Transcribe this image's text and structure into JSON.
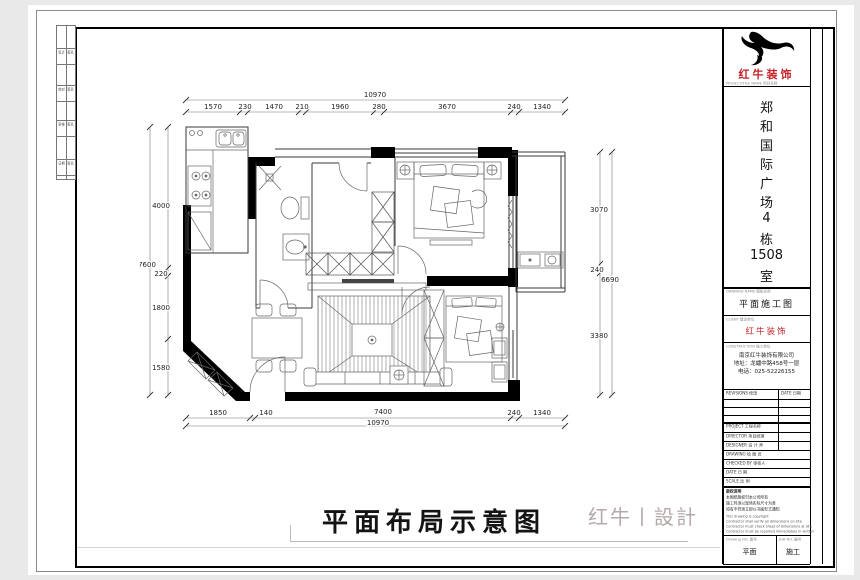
{
  "drawing": {
    "main_title": "平面布局示意图",
    "watermark": "红牛丨設計",
    "dims": {
      "top_overall": "10970",
      "top_segments": [
        "1570",
        "230",
        "1470",
        "210",
        "1960",
        "280",
        "3670",
        "240",
        "1340"
      ],
      "bottom_segments": [
        "1850",
        "140",
        "7400",
        "240",
        "1340"
      ],
      "bottom_overall": "10970",
      "left_overall": "7600",
      "left_segments": [
        "4000",
        "220",
        "1800",
        "1580"
      ],
      "right_segments": [
        "3070",
        "240",
        "3380"
      ],
      "right_overall": "6690"
    }
  },
  "title_block": {
    "brand": "红牛装饰",
    "brand_caption": "PROJECT/FILE NAME 项目名称",
    "project_name_chars": [
      "郑",
      "和",
      "国",
      "际",
      "广",
      "场",
      "4",
      "栋",
      "1508",
      "室"
    ],
    "drawing_name_label": "DRAWING NAME 图纸名称",
    "drawing_name": "平面施工图",
    "client_label": "CLIENT 建设单位",
    "client": "红牛装饰",
    "company_label": "CONSTRUCTION 施工单位",
    "company_lines": [
      "南京红牛装饰有限公司",
      "地址：龙蟠中路458号一层",
      "电话：025-52226155"
    ],
    "revisions_label": "REVISIONS 修改",
    "date_col_label": "DATE 日期",
    "rows": [
      "PROJECT 工程名称",
      "DIRECTOR 项目经理",
      "DESIGNER 设 计 师",
      "DRAWING 绘 图 员",
      "CHECKED BY 审核人",
      "DATE 日 期",
      "SCALE 比 例"
    ],
    "notes_title": "版权说明",
    "notes_cn": [
      "本图纸版权归本公司所有",
      "施工时须以现场实际尺寸为准",
      "如有不符须立即以书面形式通知"
    ],
    "notes_en": [
      "This drawing is copyright",
      "Contractor shall verify all dimensions on site",
      "Contractor must check sheet of dimensions at site",
      "Contractor must be reported immediately in written"
    ],
    "drawing_no_label": "Drawing NO. 图号",
    "drawing_no": "平面",
    "job_label": "JOB NO. 编号",
    "job": "施工"
  },
  "sign_strip": {
    "cells": [
      "设计",
      "签名",
      "校对",
      "签名",
      "审核",
      "签名",
      "日期",
      "签名"
    ]
  }
}
